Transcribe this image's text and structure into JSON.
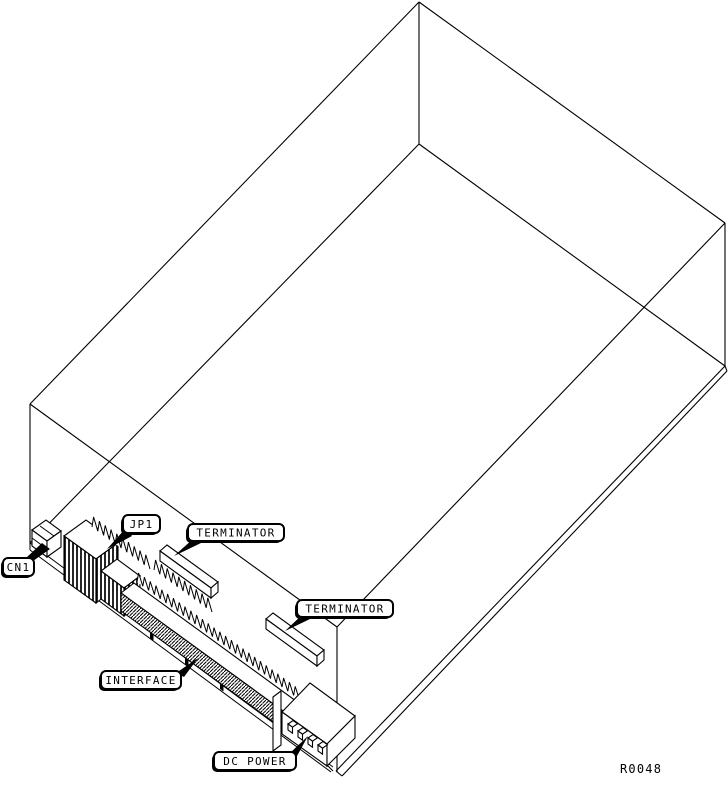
{
  "colors": {
    "ink": "#000000",
    "paper": "#ffffff"
  },
  "callouts": {
    "cn1": {
      "text": "CN1"
    },
    "jp1": {
      "text": "JP1"
    },
    "terminator_upper": {
      "text": "TERMINATOR"
    },
    "terminator_lower": {
      "text": "TERMINATOR"
    },
    "interface": {
      "text": "INTERFACE"
    },
    "dc_power": {
      "text": "DC POWER"
    }
  },
  "figure_ref": {
    "text": "R0048"
  }
}
